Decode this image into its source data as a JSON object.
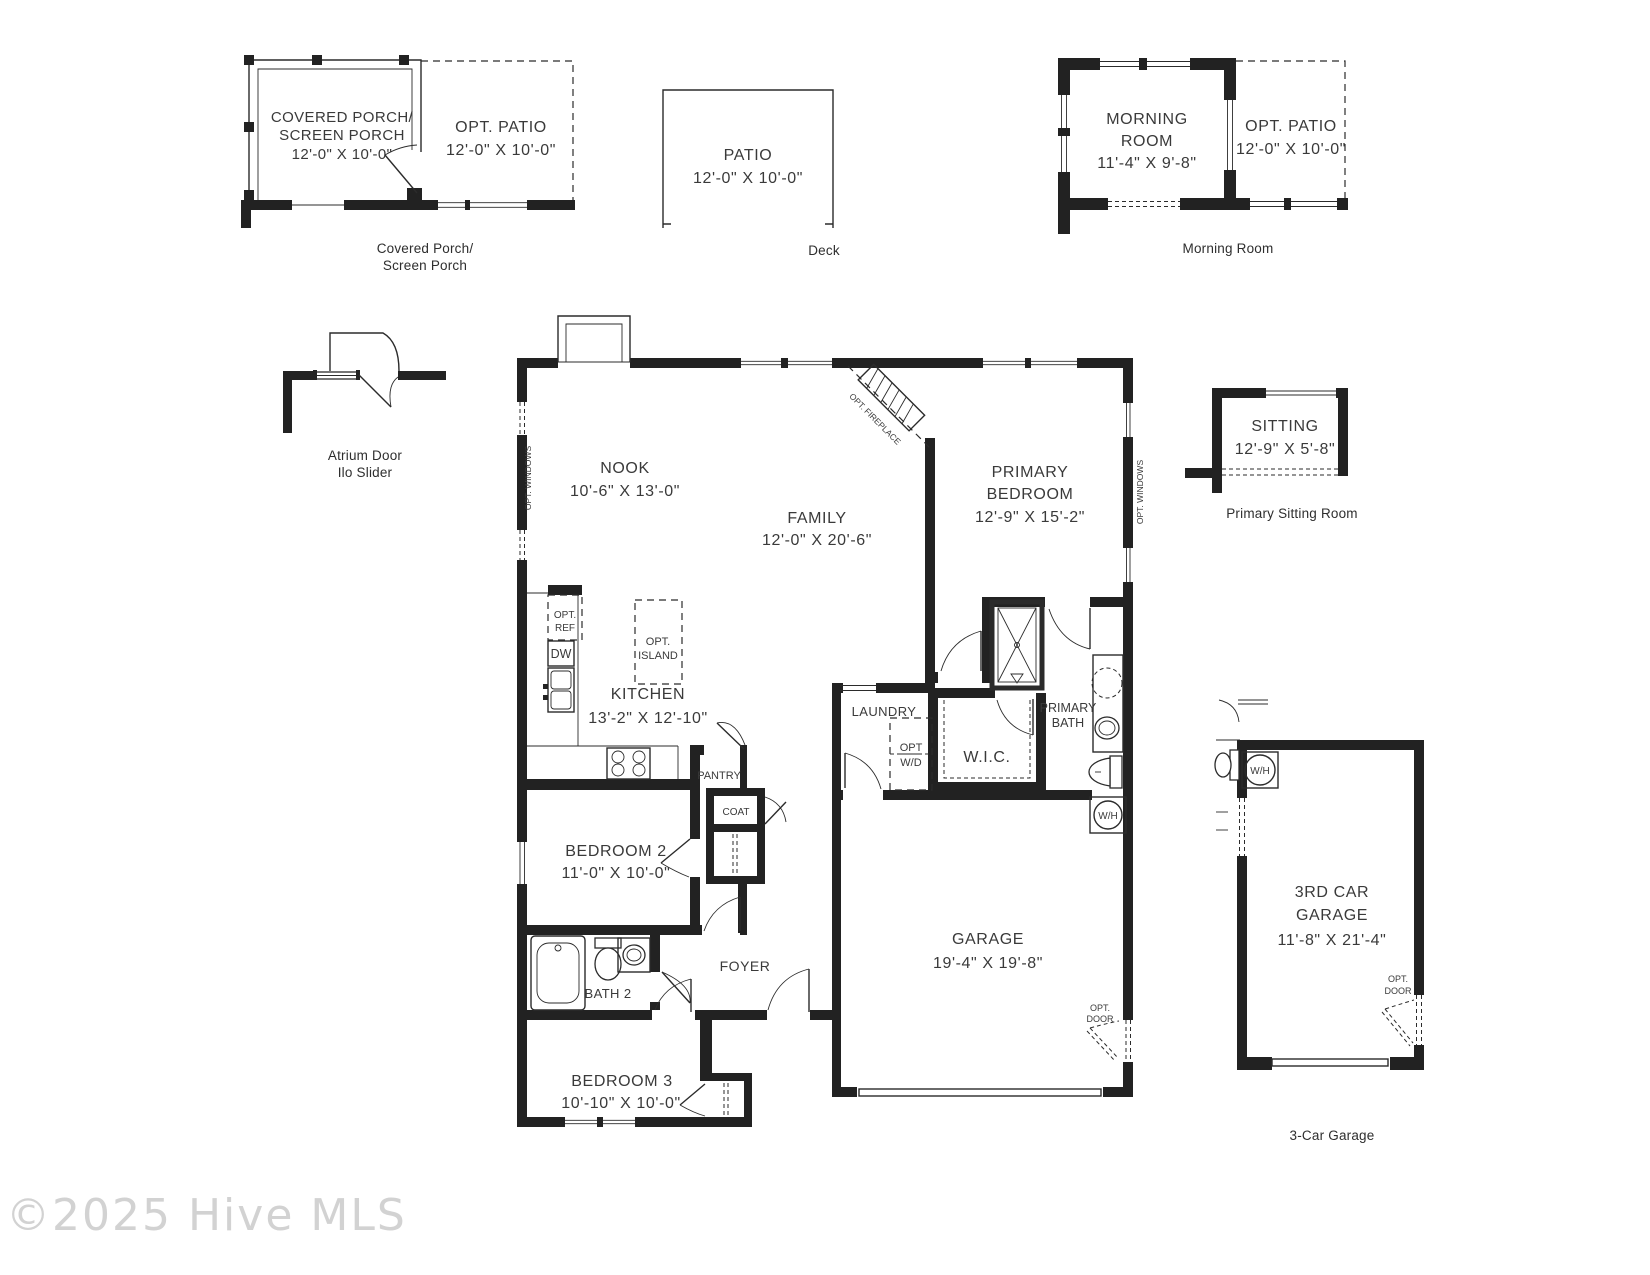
{
  "watermark": "©2025 Hive MLS",
  "plans": {
    "covered_porch": {
      "label1": "COVERED PORCH/",
      "label2": "SCREEN PORCH",
      "dims": "12'-0\" X 10'-0\"",
      "caption1": "Covered Porch/",
      "caption2": "Screen Porch"
    },
    "opt_patio_left": {
      "label": "OPT. PATIO",
      "dims": "12'-0\" X 10'-0\""
    },
    "patio": {
      "label": "PATIO",
      "dims": "12'-0\" X 10'-0\"",
      "caption": "Deck"
    },
    "morning": {
      "label1": "MORNING",
      "label2": "ROOM",
      "dims": "11'-4\" X 9'-8\"",
      "caption": "Morning Room"
    },
    "opt_patio_right": {
      "label": "OPT. PATIO",
      "dims": "12'-0\" X 10'-0\""
    },
    "atrium": {
      "caption1": "Atrium Door",
      "caption2": "Ilo Slider"
    },
    "sitting": {
      "label": "SITTING",
      "dims": "12'-9\" X 5'-8\"",
      "caption": "Primary Sitting Room"
    },
    "garage3": {
      "label1": "3RD CAR",
      "label2": "GARAGE",
      "dims": "11'-8\" X 21'-4\"",
      "caption": "3-Car Garage"
    }
  },
  "rooms": {
    "nook": {
      "name": "NOOK",
      "dims": "10'-6\" X 13'-0\""
    },
    "family": {
      "name": "FAMILY",
      "dims": "12'-0\" X 20'-6\""
    },
    "primary_bedroom": {
      "name1": "PRIMARY",
      "name2": "BEDROOM",
      "dims": "12'-9\" X 15'-2\""
    },
    "kitchen": {
      "name": "KITCHEN",
      "dims": "13'-2\" X 12'-10\""
    },
    "laundry": {
      "name": "LAUNDRY"
    },
    "wic": {
      "name": "W.I.C."
    },
    "primary_bath": {
      "name1": "PRIMARY",
      "name2": "BATH"
    },
    "bedroom2": {
      "name": "BEDROOM 2",
      "dims": "11'-0\" X 10'-0\""
    },
    "bath2": {
      "name": "BATH 2"
    },
    "foyer": {
      "name": "FOYER"
    },
    "bedroom3": {
      "name": "BEDROOM 3",
      "dims": "10'-10\" X 10'-0\""
    },
    "garage": {
      "name": "GARAGE",
      "dims": "19'-4\" X 19'-8\""
    }
  },
  "annotations": {
    "opt_ref1": "OPT.",
    "opt_ref2": "REF",
    "dw": "DW",
    "opt_island1": "OPT.",
    "opt_island2": "ISLAND",
    "pantry": "PANTRY",
    "coat": "COAT",
    "opt_wd1": "OPT",
    "opt_wd2": "W/D",
    "wh": "W/H",
    "opt_door1": "OPT.",
    "opt_door2": "DOOR",
    "opt_windows": "OPT. WINDOWS",
    "opt_fireplace": "OPT. FIREPLACE"
  }
}
